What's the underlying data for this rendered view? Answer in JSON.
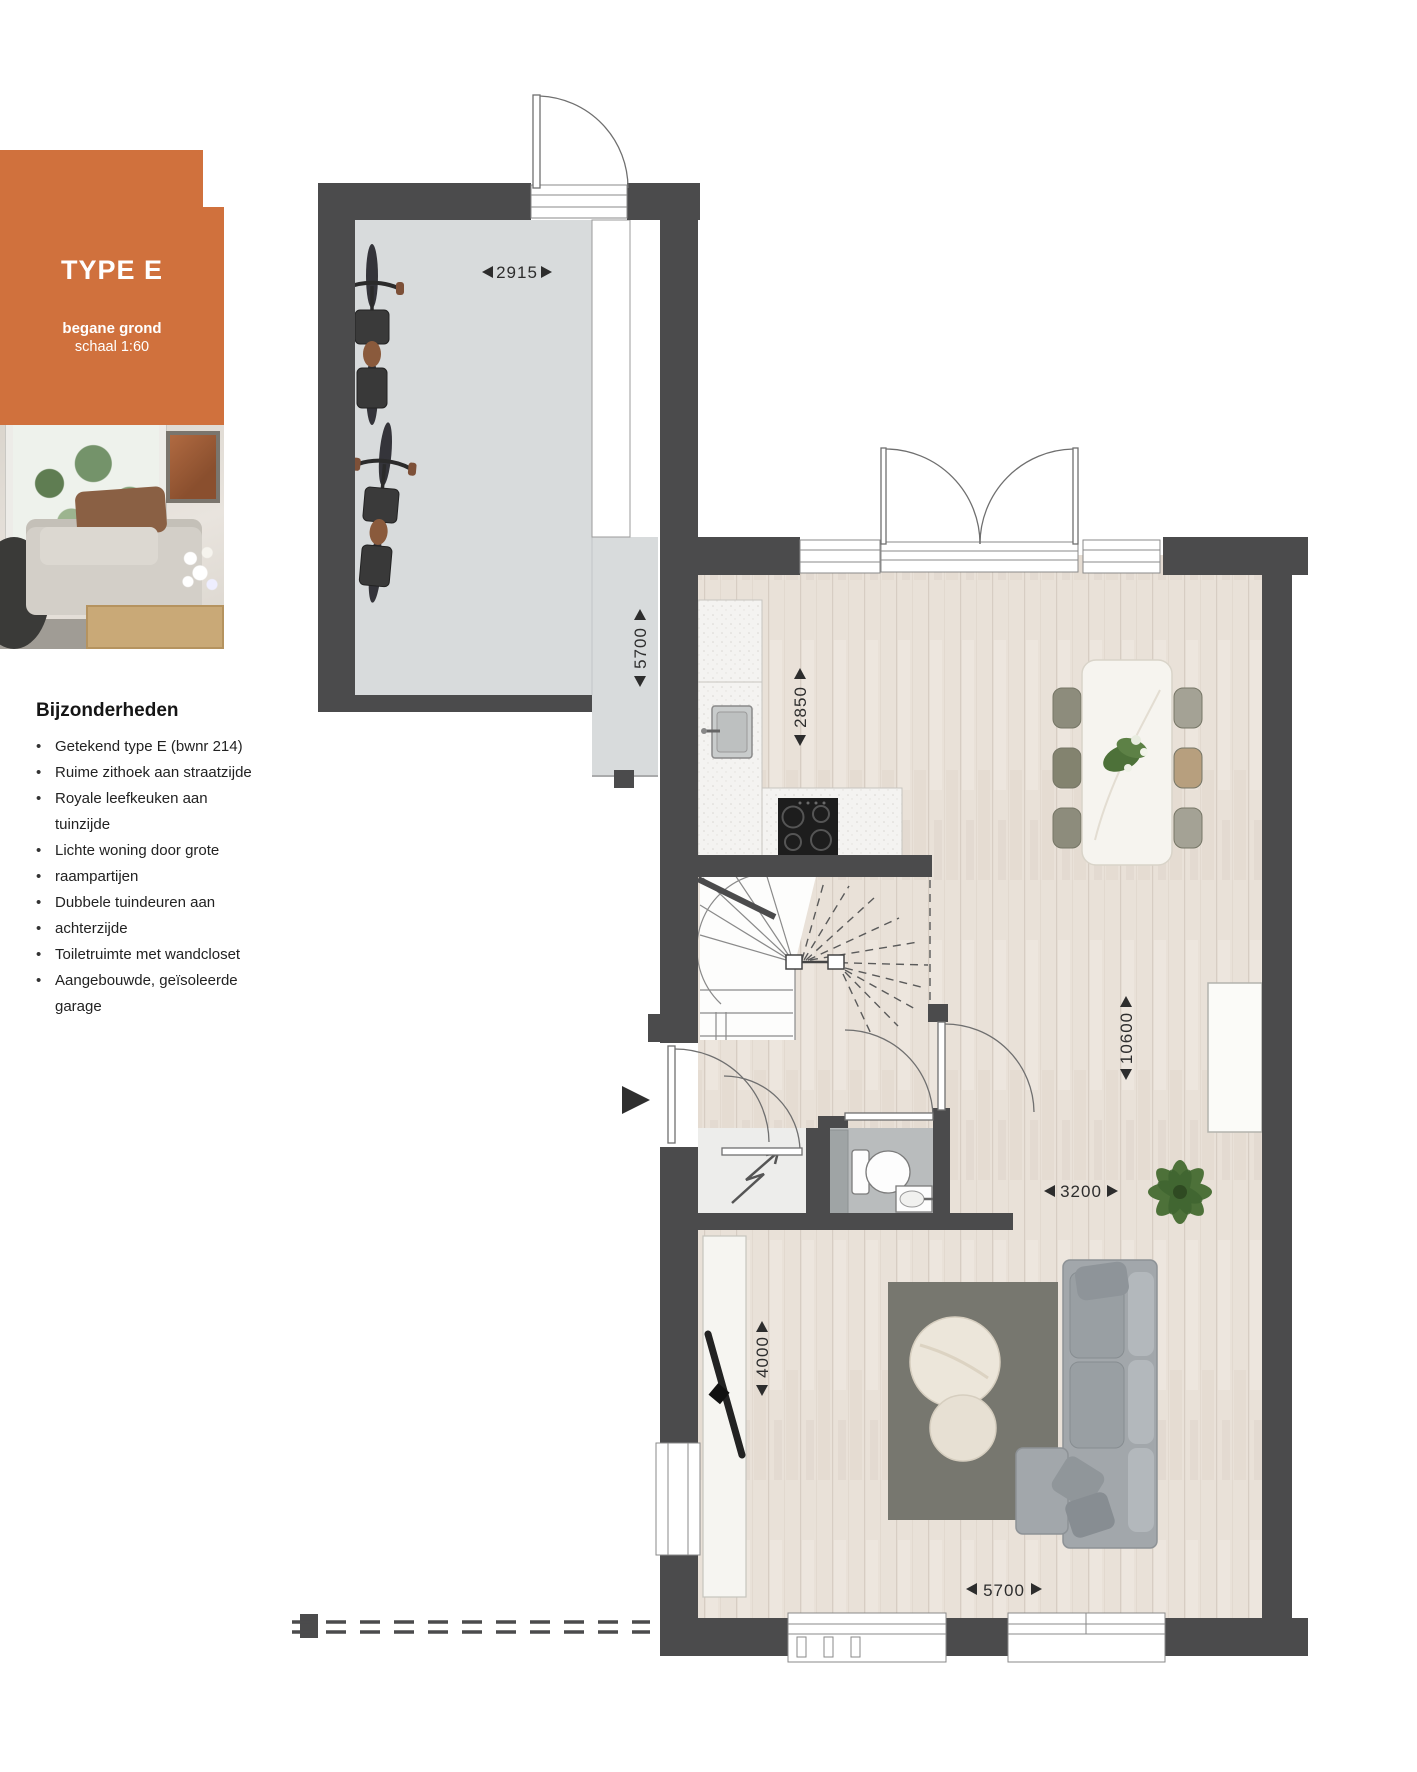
{
  "header": {
    "type_label": "TYPE E",
    "floor_label": "begane grond",
    "scale_label": "schaal 1:60"
  },
  "features": {
    "title": "Bijzonderheden",
    "lines": [
      {
        "text": "Getekend type E (bwnr 214)",
        "bullet": true
      },
      {
        "text": "Ruime zithoek aan straatzijde",
        "bullet": true
      },
      {
        "text": "Royale leefkeuken aan",
        "bullet": true
      },
      {
        "text": "tuinzijde",
        "bullet": false
      },
      {
        "text": "Lichte woning door grote",
        "bullet": true
      },
      {
        "text": "raampartijen",
        "bullet": true
      },
      {
        "text": "Dubbele tuindeuren aan",
        "bullet": true
      },
      {
        "text": "achterzijde",
        "bullet": true
      },
      {
        "text": "Toiletruimte met wandcloset",
        "bullet": true
      },
      {
        "text": "Aangebouwde, geïsoleerde",
        "bullet": true
      },
      {
        "text": "garage",
        "bullet": false
      }
    ]
  },
  "plan": {
    "dimensions": {
      "garage_width": "2915",
      "garage_length": "5700",
      "kitchen_width": "2850",
      "house_length": "10600",
      "living_width": "3200",
      "sitting_depth": "4000",
      "house_width": "5700"
    }
  },
  "colors": {
    "accent_orange": "#d0713d",
    "wall_dark": "#4b4b4c",
    "wood_floor": "#e9e1d8",
    "garage_floor": "#d8dbdc"
  }
}
